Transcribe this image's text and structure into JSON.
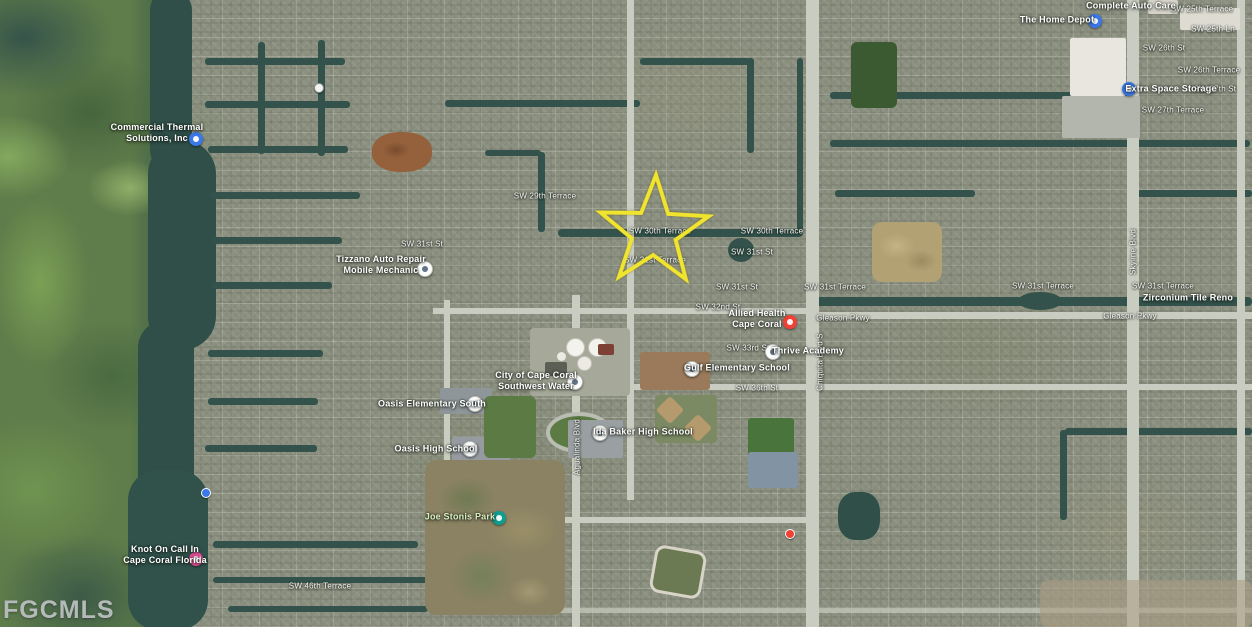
{
  "watermark": {
    "text": "FGCMLS"
  },
  "star": {
    "x": 654,
    "y": 232,
    "color": "#f0e42e"
  },
  "colors": {
    "marker_blue": "#3a78e7",
    "marker_red": "#ef4136",
    "marker_pink": "#ea4f9b",
    "marker_teal": "#0f9d8f",
    "watermark": "#b4bab8",
    "canal": "#33524b",
    "road": "#c9cdc1"
  },
  "street_labels": [
    {
      "text": "SW 29th Terrace",
      "x": 545,
      "y": 196
    },
    {
      "text": "SW 30th Terrace",
      "x": 660,
      "y": 231
    },
    {
      "text": "SW 30th Terrace",
      "x": 772,
      "y": 231
    },
    {
      "text": "SW 31st St",
      "x": 752,
      "y": 252
    },
    {
      "text": "SW 31st Terrace",
      "x": 655,
      "y": 260
    },
    {
      "text": "SW 31st St",
      "x": 737,
      "y": 287
    },
    {
      "text": "SW 31st Terrace",
      "x": 835,
      "y": 287
    },
    {
      "text": "SW 32nd St",
      "x": 718,
      "y": 307
    },
    {
      "text": "SW 31st St",
      "x": 422,
      "y": 244
    },
    {
      "text": "Gleason Pkwy",
      "x": 843,
      "y": 318
    },
    {
      "text": "Gleason Pkwy",
      "x": 1130,
      "y": 316
    },
    {
      "text": "SW 33rd St",
      "x": 748,
      "y": 348
    },
    {
      "text": "SW 36th St",
      "x": 757,
      "y": 388
    },
    {
      "text": "SW 31st Terrace",
      "x": 1043,
      "y": 286
    },
    {
      "text": "SW 31st Terrace",
      "x": 1163,
      "y": 286
    },
    {
      "text": "SW 25th Terrace",
      "x": 1202,
      "y": 9
    },
    {
      "text": "SW 25th Ln",
      "x": 1213,
      "y": 29
    },
    {
      "text": "SW 26th St",
      "x": 1164,
      "y": 48
    },
    {
      "text": "SW 26th Terrace",
      "x": 1209,
      "y": 70
    },
    {
      "text": "SW 27th St",
      "x": 1215,
      "y": 89
    },
    {
      "text": "SW 27th Terrace",
      "x": 1173,
      "y": 110
    },
    {
      "text": "SW 46th Terrace",
      "x": 320,
      "y": 586
    },
    {
      "text": "Agualinda Blvd",
      "x": 577,
      "y": 447,
      "rot": -90
    },
    {
      "text": "Chiquita Blvd S",
      "x": 820,
      "y": 362,
      "rot": -90
    },
    {
      "text": "Skyline Blvd",
      "x": 1133,
      "y": 252,
      "rot": -90
    }
  ],
  "poi_labels": [
    {
      "lines": [
        "Commercial Thermal",
        "Solutions, Inc"
      ],
      "x": 157,
      "y": 133,
      "marker": {
        "type": "blue",
        "x": 196,
        "y": 139
      }
    },
    {
      "lines": [
        "Tizzano Auto Repair",
        "Mobile Mechanic"
      ],
      "x": 381,
      "y": 265,
      "marker": {
        "type": "white",
        "x": 424,
        "y": 268
      }
    },
    {
      "lines": [
        "City of Cape Coral",
        "Southwest Water"
      ],
      "x": 536,
      "y": 381,
      "marker": {
        "type": "white",
        "x": 574,
        "y": 381
      }
    },
    {
      "lines": [
        "Oasis Elementary South"
      ],
      "x": 432,
      "y": 404,
      "marker": {
        "type": "white",
        "x": 474,
        "y": 403
      }
    },
    {
      "lines": [
        "Oasis High School"
      ],
      "x": 436,
      "y": 449,
      "marker": {
        "type": "white",
        "x": 469,
        "y": 448
      }
    },
    {
      "lines": [
        "Ida Baker High School"
      ],
      "x": 643,
      "y": 432,
      "marker": {
        "type": "white",
        "x": 599,
        "y": 432
      }
    },
    {
      "lines": [
        "Gulf Elementary School"
      ],
      "x": 737,
      "y": 368,
      "marker": {
        "type": "white",
        "x": 691,
        "y": 368
      }
    },
    {
      "lines": [
        "Thrive Academy"
      ],
      "x": 808,
      "y": 351,
      "marker": {
        "type": "white",
        "x": 772,
        "y": 351
      }
    },
    {
      "lines": [
        "Allied Health",
        "Cape Coral"
      ],
      "x": 757,
      "y": 319,
      "marker": {
        "type": "red",
        "x": 790,
        "y": 322
      }
    },
    {
      "lines": [
        "Knot On Call In",
        "Cape Coral Florida"
      ],
      "x": 165,
      "y": 555,
      "marker": {
        "type": "pink",
        "x": 196,
        "y": 559
      }
    },
    {
      "lines": [
        "Extra Space Storage"
      ],
      "x": 1171,
      "y": 89,
      "marker": {
        "type": "blue",
        "x": 1129,
        "y": 89
      }
    },
    {
      "lines": [
        "The Home Depot"
      ],
      "x": 1057,
      "y": 20,
      "marker": {
        "type": "blue",
        "x": 1095,
        "y": 21
      }
    },
    {
      "lines": [
        "Complete Auto Care"
      ],
      "x": 1131,
      "y": 6
    },
    {
      "lines": [
        "Zirconium Tile Reno"
      ],
      "x": 1188,
      "y": 298
    },
    {
      "lines": [
        "Joe Stonis Park"
      ],
      "x": 460,
      "y": 517,
      "park": true,
      "marker": {
        "type": "teal",
        "x": 499,
        "y": 518
      }
    }
  ],
  "dot_markers": [
    {
      "x": 205,
      "y": 492,
      "type": "blue"
    },
    {
      "x": 318,
      "y": 87,
      "type": "white"
    },
    {
      "x": 789,
      "y": 533,
      "type": "red"
    }
  ]
}
